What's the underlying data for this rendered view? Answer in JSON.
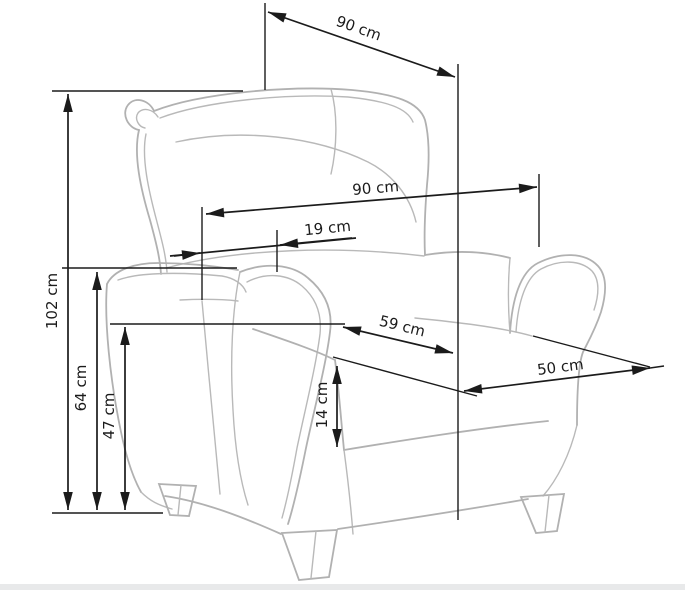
{
  "diagram": {
    "type": "furniture-dimension-diagram",
    "subject": "wingback recliner armchair line drawing",
    "unit": "cm",
    "colors": {
      "background": "#ffffff",
      "dimension_lines": "#1b1b1b",
      "chair_outline": "#b1b1b1",
      "floor_strip": "#e8e9ea"
    },
    "labels": {
      "depth_overall": "90 cm",
      "width_overall": "90 cm",
      "backrest_offset": "19 cm",
      "height_overall": "102 cm",
      "armrest_height": "64 cm",
      "seat_height": "47 cm",
      "cushion_thickness": "14 cm",
      "seat_width": "59 cm",
      "seat_depth": "50 cm"
    },
    "measurements": [
      {
        "name": "overall depth (top diagonal)",
        "value": 90,
        "unit": "cm"
      },
      {
        "name": "overall width",
        "value": 90,
        "unit": "cm"
      },
      {
        "name": "backrest offset",
        "value": 19,
        "unit": "cm"
      },
      {
        "name": "overall height",
        "value": 102,
        "unit": "cm"
      },
      {
        "name": "armrest height",
        "value": 64,
        "unit": "cm"
      },
      {
        "name": "seat height",
        "value": 47,
        "unit": "cm"
      },
      {
        "name": "seat cushion thickness",
        "value": 14,
        "unit": "cm"
      },
      {
        "name": "seat width",
        "value": 59,
        "unit": "cm"
      },
      {
        "name": "seat depth",
        "value": 50,
        "unit": "cm"
      }
    ]
  }
}
